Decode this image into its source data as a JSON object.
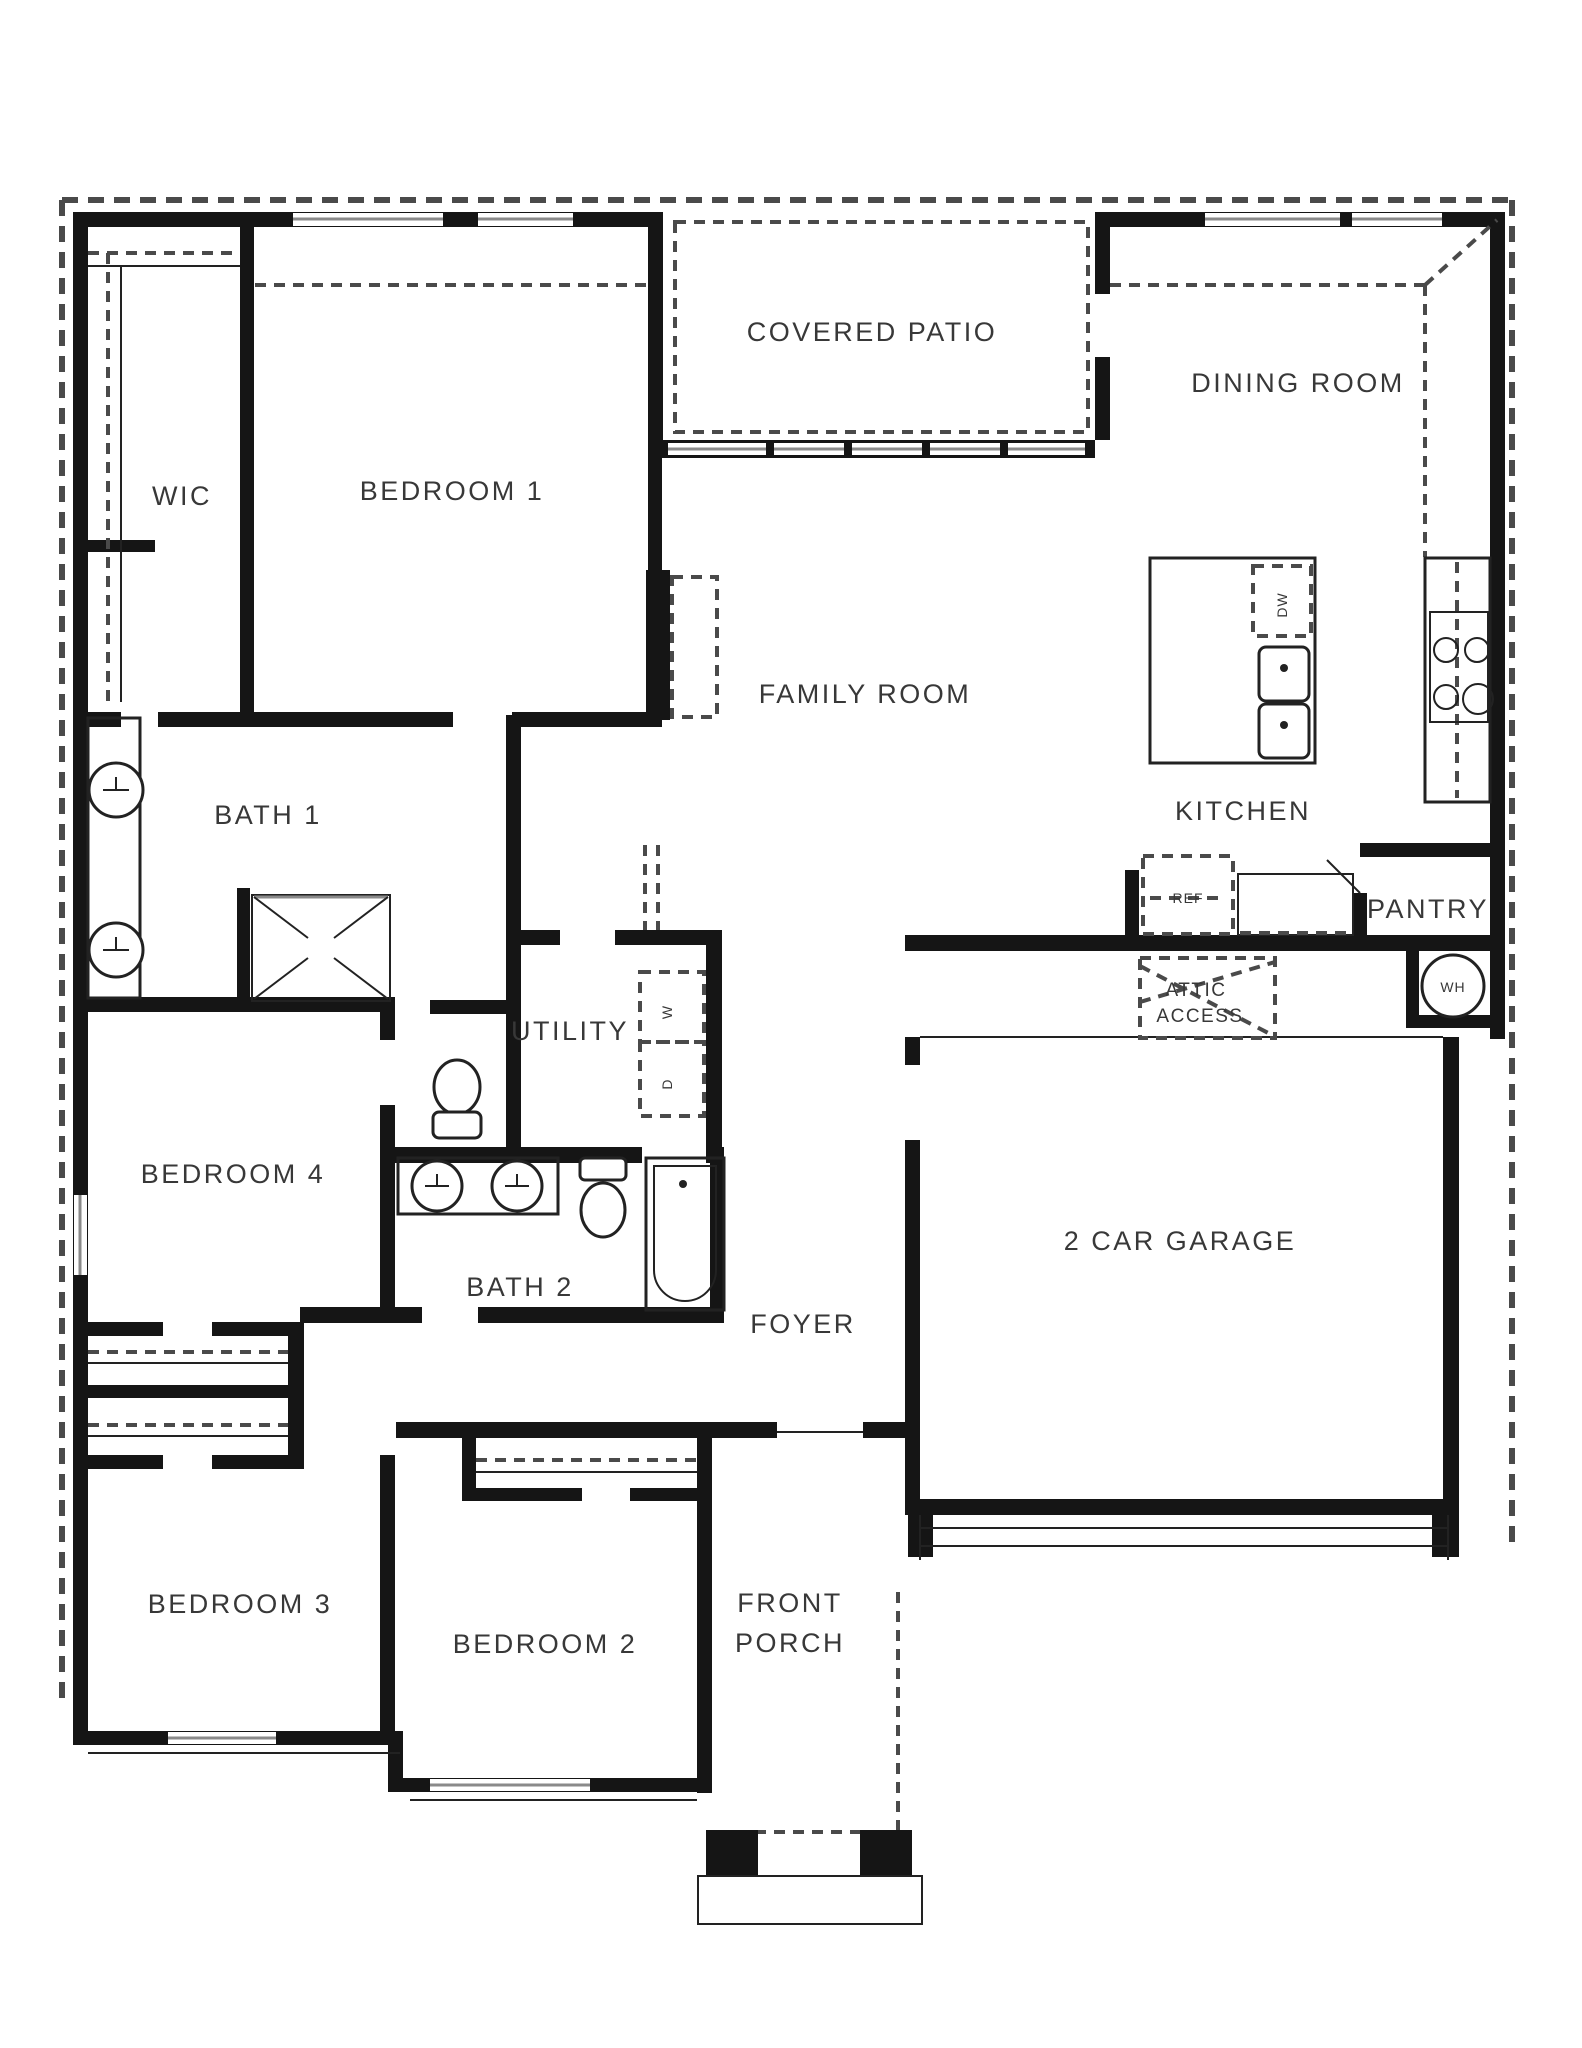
{
  "floor_plan": {
    "rooms": {
      "wic": "WIC",
      "bedroom1": "BEDROOM 1",
      "covered_patio": "COVERED PATIO",
      "dining_room": "DINING ROOM",
      "family_room": "FAMILY ROOM",
      "kitchen": "KITCHEN",
      "bath1": "BATH 1",
      "pantry": "PANTRY",
      "utility": "UTILITY",
      "bedroom4": "BEDROOM 4",
      "bath2": "BATH 2",
      "garage": "2 CAR GARAGE",
      "foyer": "FOYER",
      "bedroom3": "BEDROOM 3",
      "bedroom2": "BEDROOM 2"
    },
    "labels_multiline": {
      "front_porch": [
        "FRONT",
        "PORCH"
      ],
      "attic_access": [
        "ATTIC",
        "ACCESS"
      ]
    },
    "appliances": {
      "refrigerator": "REF",
      "dishwasher": "DW",
      "washer": "W",
      "dryer": "D",
      "water_heater": "WH"
    },
    "colors": {
      "background": "#ffffff",
      "wall": "#151515",
      "label_text": "#383838",
      "dashed_line": "#4a4a4a",
      "window_line": "#8a8a8a"
    }
  }
}
